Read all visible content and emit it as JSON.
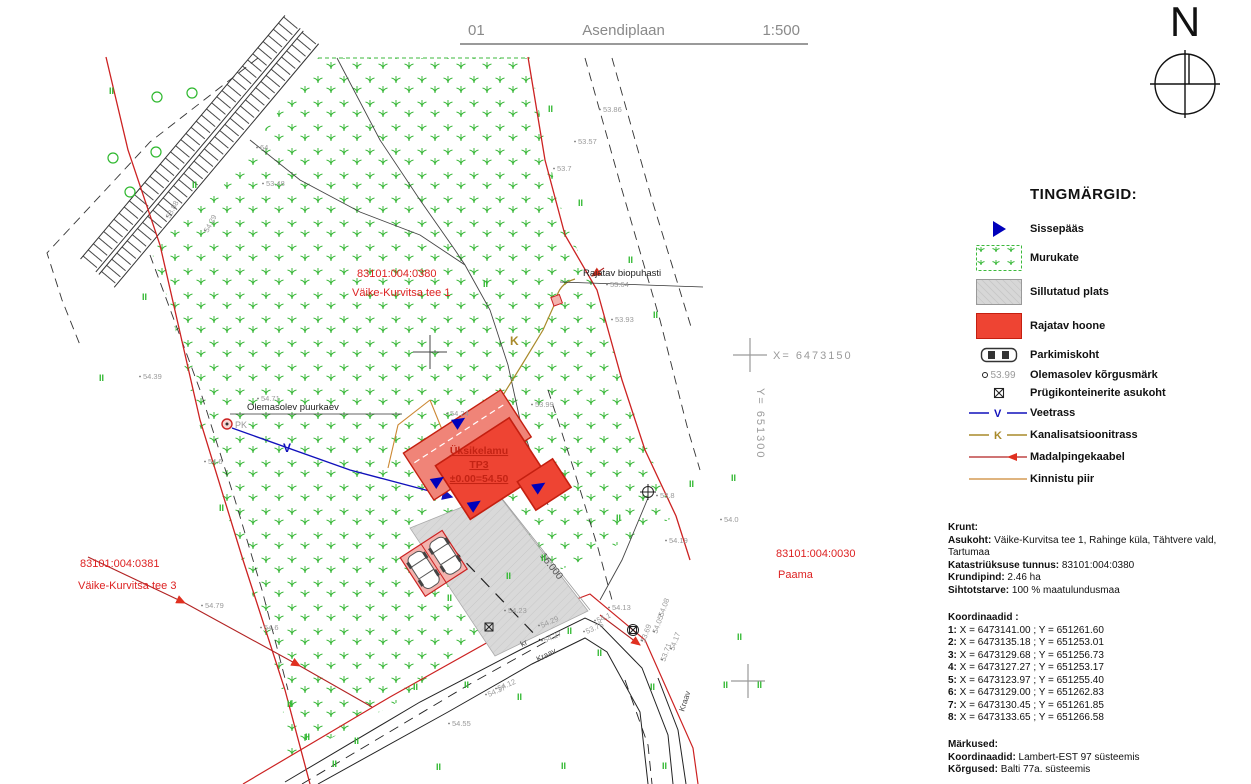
{
  "title": {
    "number": "01",
    "name": "Asendiplaan",
    "scale": "1:500"
  },
  "north_label": "N",
  "legend": {
    "heading": "TINGMÄRGID:",
    "items": [
      {
        "label": "Sissepääs",
        "icon": "entrance-arrow"
      },
      {
        "label": "Murukate",
        "icon": "grass-swatch"
      },
      {
        "label": "Sillutatud plats",
        "icon": "paved-swatch"
      },
      {
        "label": "Rajatav hoone",
        "icon": "building-swatch"
      },
      {
        "label": "Parkimiskoht",
        "icon": "car"
      },
      {
        "label": "Olemasolev kõrgusmärk",
        "icon": "elevation-mark",
        "sample": "53.99"
      },
      {
        "label": "Prügikonteinerite asukoht",
        "icon": "waste-box"
      },
      {
        "label": "Veetrass",
        "icon": "water-line",
        "letter": "V"
      },
      {
        "label": "Kanalisatsioonitrass",
        "icon": "sewer-line",
        "letter": "K"
      },
      {
        "label": "Madalpingekaabel",
        "icon": "lv-cable"
      },
      {
        "label": "Kinnistu piir",
        "icon": "property-line"
      }
    ]
  },
  "info": {
    "krunt": {
      "heading": "Krunt:",
      "rows": [
        {
          "label": "Asukoht:",
          "value": " Väike-Kurvitsa tee 1, Rahinge küla, Tähtvere vald, Tartumaa"
        },
        {
          "label": "Katastriüksuse tunnus:",
          "value": " 83101:004:0380"
        },
        {
          "label": "Krundipind:",
          "value": " 2.46 ha"
        },
        {
          "label": "Sihtotstarve:",
          "value": " 100 % maatulundusmaa"
        }
      ]
    },
    "koordinaadid": {
      "heading": "Koordinaadid :",
      "rows": [
        {
          "n": "1:",
          "value": " X = 6473141.00 ; Y = 651261.60"
        },
        {
          "n": "2:",
          "value": " X = 6473135.18 ; Y = 651253.01"
        },
        {
          "n": "3:",
          "value": " X = 6473129.68 ; Y = 651256.73"
        },
        {
          "n": "4:",
          "value": " X = 6473127.27 ; Y = 651253.17"
        },
        {
          "n": "5:",
          "value": " X = 6473123.97 ; Y = 651255.40"
        },
        {
          "n": "6:",
          "value": " X = 6473129.00 ; Y = 651262.83"
        },
        {
          "n": "7:",
          "value": " X = 6473130.45 ; Y = 651261.85"
        },
        {
          "n": "8:",
          "value": " X = 6473133.65 ; Y = 651266.58"
        }
      ]
    },
    "markused": {
      "heading": "Märkused:",
      "rows": [
        {
          "label": "Koordinaadid:",
          "value": " Lambert-EST 97 süsteemis"
        },
        {
          "label": "Kõrgused:",
          "value": " Balti 77a. süsteemis"
        }
      ]
    }
  },
  "map": {
    "grid": {
      "x_label": "X=  6473150",
      "y_label": "Y=  651300"
    },
    "parcels": [
      {
        "code": "83101:004:0380",
        "name": "Väike-Kurvitsa tee 1"
      },
      {
        "code": "83101:004:0381",
        "name": "Väike-Kurvitsa tee 3"
      },
      {
        "code": "83101:004:0030",
        "name": "Paama"
      }
    ],
    "labels": {
      "well": "Olemasolev puurkaev",
      "well_code": "PK",
      "biotreatment": "Rajatav biopuhasti",
      "building_line1": "Üksikelamu",
      "building_line2": "TP3",
      "building_line3": "±0.00=54.50",
      "driveway_dim": "16.000",
      "ditch": "Kraav",
      "ditch2": "Kraav",
      "kr": "kr"
    },
    "line_letters": {
      "water": "V",
      "sewer": "K"
    },
    "tree_symbol": "II",
    "colors": {
      "parcel_boundary": "#cc2222",
      "building_fill": "#ee4433",
      "terrace_fill": "#f08478",
      "paved_fill": "#d9d9d9",
      "grass_green": "#3cb93c",
      "water_blue": "#1111bb",
      "sewer_olive": "#a98a2a",
      "cable_red": "#b22222",
      "property_orange": "#cc8833",
      "entrance_blue": "#0000bb",
      "elevation_gray": "#9a9a9a",
      "title_gray": "#8a8a8a",
      "label_red": "#dd2222"
    },
    "elevation_marks": [
      {
        "v": "53.57",
        "x": 578,
        "y": 144
      },
      {
        "v": "53.7",
        "x": 557,
        "y": 171
      },
      {
        "v": "53.86",
        "x": 603,
        "y": 112
      },
      {
        "v": "53.88",
        "x": 170,
        "y": 219,
        "r": -62
      },
      {
        "v": "54.29",
        "x": 208,
        "y": 233,
        "r": -62
      },
      {
        "v": "53.48",
        "x": 266,
        "y": 186
      },
      {
        "v": "64",
        "x": 260,
        "y": 150
      },
      {
        "v": "53.64",
        "x": 610,
        "y": 287
      },
      {
        "v": "53.93",
        "x": 615,
        "y": 322
      },
      {
        "v": "53.99",
        "x": 535,
        "y": 407
      },
      {
        "v": "54.71",
        "x": 261,
        "y": 401
      },
      {
        "v": "54.24",
        "x": 450,
        "y": 416
      },
      {
        "v": "54.6",
        "x": 208,
        "y": 464
      },
      {
        "v": "54.39",
        "x": 143,
        "y": 379
      },
      {
        "v": "53.8",
        "x": 660,
        "y": 498
      },
      {
        "v": "54.0",
        "x": 724,
        "y": 522
      },
      {
        "v": "54.19",
        "x": 669,
        "y": 543
      },
      {
        "v": "54.23",
        "x": 508,
        "y": 613
      },
      {
        "v": "54.29",
        "x": 542,
        "y": 628,
        "r": -24
      },
      {
        "v": "54.27",
        "x": 545,
        "y": 643,
        "r": -24
      },
      {
        "v": "54.13",
        "x": 612,
        "y": 610
      },
      {
        "v": "54.1",
        "x": 598,
        "y": 623,
        "r": -24
      },
      {
        "v": "53.76",
        "x": 587,
        "y": 634,
        "r": -24
      },
      {
        "v": "54.12",
        "x": 499,
        "y": 691,
        "r": -24
      },
      {
        "v": "54.37",
        "x": 489,
        "y": 697,
        "r": -24
      },
      {
        "v": "54.55",
        "x": 452,
        "y": 726
      },
      {
        "v": "53.69",
        "x": 645,
        "y": 643,
        "r": -70
      },
      {
        "v": "54.05",
        "x": 657,
        "y": 634,
        "r": -70
      },
      {
        "v": "54.08",
        "x": 663,
        "y": 617,
        "r": -70
      },
      {
        "v": "53.71",
        "x": 665,
        "y": 662,
        "r": -70
      },
      {
        "v": "54.17",
        "x": 674,
        "y": 651,
        "r": -70
      },
      {
        "v": "54.79",
        "x": 205,
        "y": 608
      },
      {
        "v": "54.6",
        "x": 264,
        "y": 630
      }
    ],
    "tree_marks": [
      [
        548,
        112
      ],
      [
        578,
        206
      ],
      [
        483,
        287
      ],
      [
        628,
        263
      ],
      [
        653,
        318
      ],
      [
        689,
        487
      ],
      [
        731,
        481
      ],
      [
        757,
        688
      ],
      [
        616,
        521
      ],
      [
        541,
        561
      ],
      [
        506,
        579
      ],
      [
        447,
        601
      ],
      [
        464,
        688
      ],
      [
        517,
        700
      ],
      [
        413,
        690
      ],
      [
        354,
        744
      ],
      [
        305,
        740
      ],
      [
        567,
        634
      ],
      [
        597,
        656
      ],
      [
        650,
        690
      ],
      [
        723,
        688
      ],
      [
        737,
        640
      ],
      [
        219,
        511
      ],
      [
        99,
        381
      ],
      [
        142,
        300
      ],
      [
        192,
        188
      ],
      [
        109,
        94
      ],
      [
        287,
        707
      ],
      [
        332,
        767
      ],
      [
        436,
        770
      ],
      [
        561,
        769
      ],
      [
        662,
        769
      ]
    ]
  }
}
